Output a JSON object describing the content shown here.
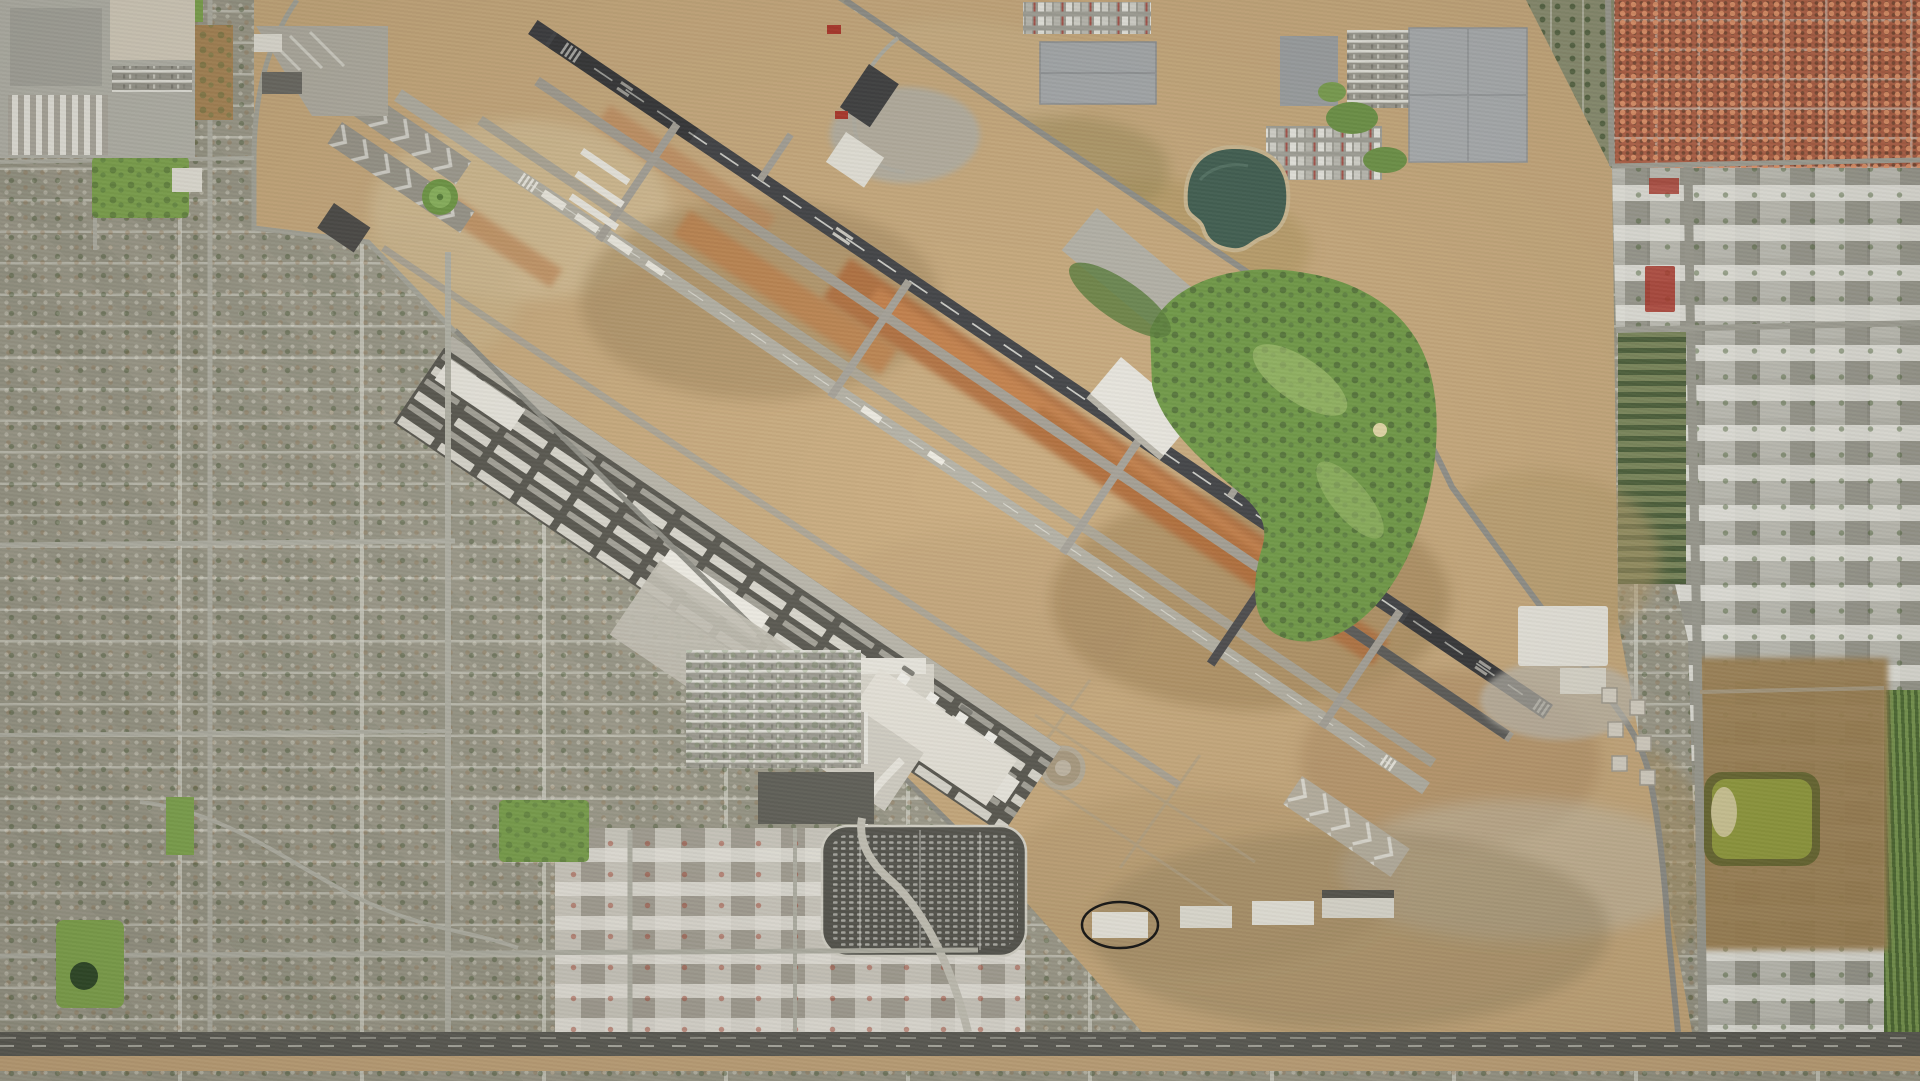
{
  "scene": {
    "type": "aerial-satellite-imagery",
    "subject": "metropolitan airport with two parallel NW-SE runways, bordered by residential grid to the west and south, industrial parks and warehouses to the north-east and east",
    "visible_text": "none",
    "annotation": {
      "shape": "ellipse",
      "center_x": 1120,
      "center_y": 925,
      "rx": 38,
      "ry": 23,
      "stroke": "#111111",
      "note": "hand-drawn black oval around a small white building south of the airfield"
    }
  },
  "palette": {
    "urban_base": "#a19f90",
    "urban_street": "#d4d4c9",
    "airport_dirt": "#c9ab7e",
    "dirt_light": "#d6c29a",
    "dirt_brown": "#a2895e",
    "dirt_orange": "#b06b3a",
    "dirt_orange_light": "#c8854e",
    "runway_asphalt": "#3f4145",
    "taxiway_gray": "#a49f94",
    "runway_b_gray": "#b4b1a5",
    "concrete": "#c4c1b6",
    "white_roof": "#e9e7df",
    "gray_roof": "#a6aaad",
    "warehouse_big": "#abafb2",
    "dark_roof": "#3d3e40",
    "shed_dark": "#57564f",
    "red_roof_zone": "#b26248",
    "red_accent": "#ad3529",
    "teal_pond": "#3f5e51",
    "pond_rim": "#cdb992",
    "olive_pond": "#949e3f",
    "olive_ring": "#6a6a33",
    "scrub_brown": "#a08355",
    "golf_green": "#6f9a46",
    "golf_tree": "#4c6a36",
    "park_green": "#7fa74f",
    "crop_dark": "#4f6d36",
    "crop_light": "#7a9a52",
    "road_major": "#5c5c56",
    "road_dash": "#d9d9cf",
    "road_city": "#b3b3a8",
    "perimeter_road": "#90908a",
    "parking_dark": "#53534d",
    "dirt_shoulder": "#c4a67c"
  },
  "features": [
    {
      "name": "airport-field",
      "desc": "large tan dirt airfield crossing the frame diagonally"
    },
    {
      "name": "runway-main",
      "desc": "dark asphalt runway running NW to SE with centerline and threshold markings"
    },
    {
      "name": "runway-secondary",
      "desc": "pale parallel runway south-west of the main runway"
    },
    {
      "name": "parallel-taxiways",
      "desc": "several gray parallel taxiways with cross connectors"
    },
    {
      "name": "orange-dirt-strips",
      "desc": "red-orange graded dirt strips between runways"
    },
    {
      "name": "compass-rose",
      "desc": "small green painted circle near the north-west runway end"
    },
    {
      "name": "terminal-complex",
      "desc": "white terminal and concourse with apron, garage and car parks"
    },
    {
      "name": "economy-parking-lot",
      "desc": "large dark lot filled with parked cars"
    },
    {
      "name": "hangar-shed-band",
      "desc": "dark band of hangars and white storage sheds along the south-west edge"
    },
    {
      "name": "warehouse-district",
      "desc": "big gray warehouse roofs, truck yards and parking at top right"
    },
    {
      "name": "golf-course",
      "desc": "green course with tree clumps east of the perimeter road"
    },
    {
      "name": "retention-pond-teal",
      "desc": "dark teal pond north-east of the field"
    },
    {
      "name": "retention-pond-olive",
      "desc": "olive-green pond near the bottom right"
    },
    {
      "name": "red-roof-neighborhood",
      "desc": "red tiled roofs in the top right corner"
    },
    {
      "name": "residential-grid-west",
      "desc": "dense suburban street grid on the left half"
    },
    {
      "name": "arterial-road",
      "desc": "major east-west road across the bottom of the image"
    },
    {
      "name": "annotation-ellipse",
      "desc": "black oval annotation around a small white building"
    }
  ]
}
